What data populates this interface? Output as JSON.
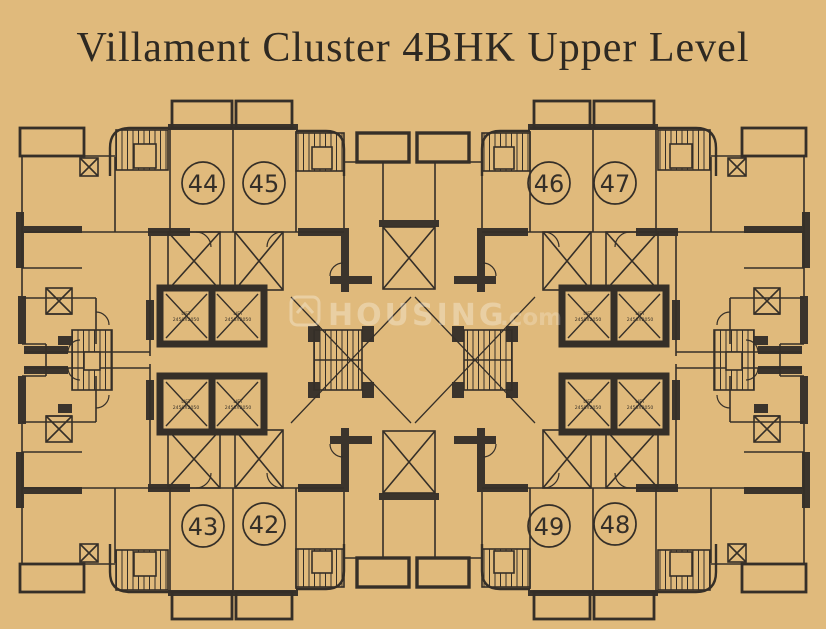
{
  "title": "Villament Cluster 4BHK Upper Level",
  "units": {
    "u44": "44",
    "u45": "45",
    "u46": "46",
    "u47": "47",
    "u43": "43",
    "u42": "42",
    "u49": "49",
    "u48": "48"
  },
  "lift": {
    "name": "LIFT",
    "size": "2450X2050"
  },
  "watermark": {
    "brand": "HOUSING",
    "tld": ".com"
  },
  "colors": {
    "background": "#e0ba7c",
    "line": "#352f28",
    "wall": "#3b342c",
    "title_text": "#2e2922",
    "watermark": "#ffffff"
  }
}
